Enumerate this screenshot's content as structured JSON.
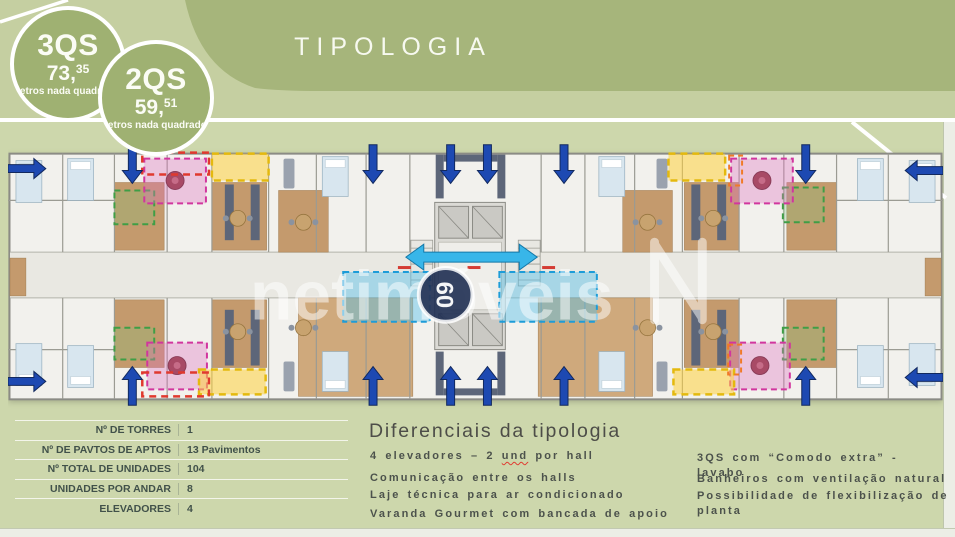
{
  "header": {
    "title": "TIPOLOGIA"
  },
  "badges": [
    {
      "name": "3QS",
      "area_main": "73,",
      "area_sup": "35",
      "unit": "Metros nada quadrados"
    },
    {
      "name": "2QS",
      "area_main": "59,",
      "area_sup": "51",
      "unit": "Metros nada quadrados"
    }
  ],
  "specs": {
    "rows": [
      {
        "label": "Nº DE TORRES",
        "value": "1"
      },
      {
        "label": "Nº DE PAVTOS DE APTOS",
        "value": "13 Pavimentos"
      },
      {
        "label": "Nº TOTAL DE UNIDADES",
        "value": "104"
      },
      {
        "label": "UNIDADES POR ANDAR",
        "value": "8"
      },
      {
        "label": "ELEVADORES",
        "value": "4"
      }
    ]
  },
  "differentials": {
    "title": "Diferenciais da tipologia",
    "first_item": {
      "pre": "4 elevadores – 2 ",
      "word": "und",
      "post": " por hall"
    },
    "left_items": [
      "Comunicação entre os halls",
      "Laje técnica para ar condicionado",
      "Varanda Gourmet com bancada de apoio"
    ],
    "right_items": [
      "3QS com “Comodo extra” - lavabo",
      "Banheiros com ventilação natural",
      "Possibilidade de flexibilização de planta"
    ]
  },
  "watermark": {
    "text": "netimóveis",
    "logo_text": "60"
  },
  "colors": {
    "header_green": "#a6b57b",
    "panel_green": "#cdd7ac",
    "badge_green": "#9fb172",
    "arrow_blue": "#1d49b2",
    "hall_cyan": "#38b6e9",
    "highlight_pink": "#d1369e",
    "highlight_yellow": "#e4b90e",
    "highlight_green": "#3f9e46",
    "highlight_red": "#e0392e",
    "laje_cyan": "#1d9cd8"
  }
}
